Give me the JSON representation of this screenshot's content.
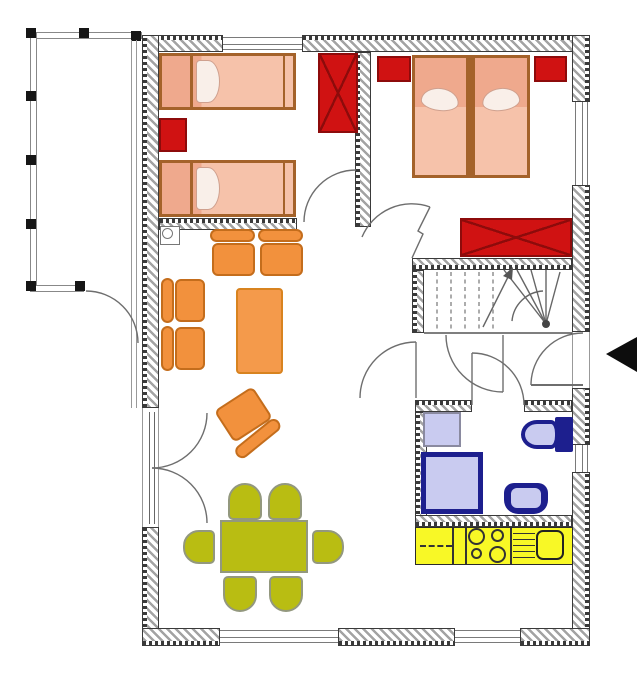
{
  "title": "apartment-floor-plan",
  "palette": {
    "wall-line": "#3a3a3a",
    "wall-hatch": "#a3a3a3",
    "window-line": "#7a7a7a",
    "door-arc": "#6e6e6e",
    "rail": "#888888",
    "bed-fill": "#f6c2aa",
    "bed-dark": "#efa98d",
    "bed-frame": "#a4622a",
    "pillow": "#f9efe9",
    "red": "#d01212",
    "red-dark": "#8d0b0b",
    "orange": "#f2913d",
    "orange-border": "#c46d1c",
    "table-orange": "#f49a4b",
    "green": "#b9bd12",
    "green-border": "#93987e",
    "lavender": "#c9cbf0",
    "navy": "#1d1f8e",
    "kitchen-yellow": "#f8f826",
    "entrance-arrow": "#0d0d0d"
  },
  "inventory": {
    "single_beds": 2,
    "double_beds": 1,
    "wardrobes_crossed": 2,
    "red_cabinets": 3,
    "sofa_seats": 4,
    "armchairs": 1,
    "coffee_tables": 1,
    "dining_chairs": 6,
    "dining_tables": 1,
    "stair_flights": 1,
    "bathroom_fixtures": [
      "washer",
      "shower",
      "toilet",
      "wash-basin"
    ],
    "kitchen_fixtures": [
      "worktop",
      "hob-4-burners",
      "sink"
    ],
    "balcony": 1,
    "entrance_arrow": 1
  }
}
